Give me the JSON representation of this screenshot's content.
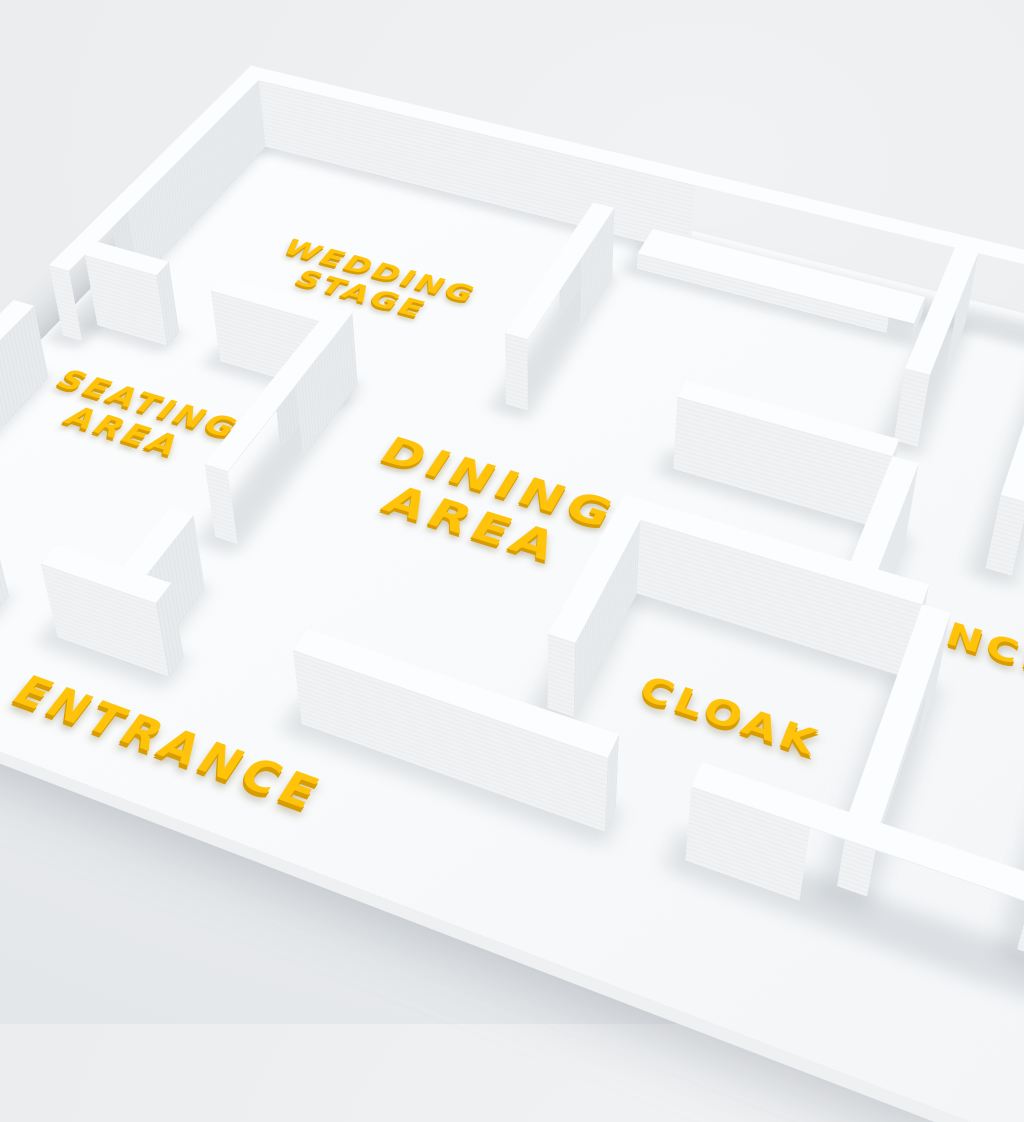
{
  "scene": {
    "description": "3D wedding venue floor plan model"
  },
  "labels": {
    "wedding_stage": "WEDDING\nSTAGE",
    "seating_area": "SEATING\nAREA",
    "dining_area": "DINING\nAREA",
    "dance": "DANCE",
    "cloak": "CLOAK",
    "entrance": "ENTRANCE"
  },
  "colors": {
    "label_text": "#FFC40A",
    "label_extrude": "#D99C00",
    "background": "#EBEDEF",
    "model_top": "#FCFDFE",
    "model_south": "#F0F2F4",
    "model_east": "#E7EBEE",
    "model_west": "#E3E7EA",
    "slab_edge": "#EEF0F2"
  }
}
